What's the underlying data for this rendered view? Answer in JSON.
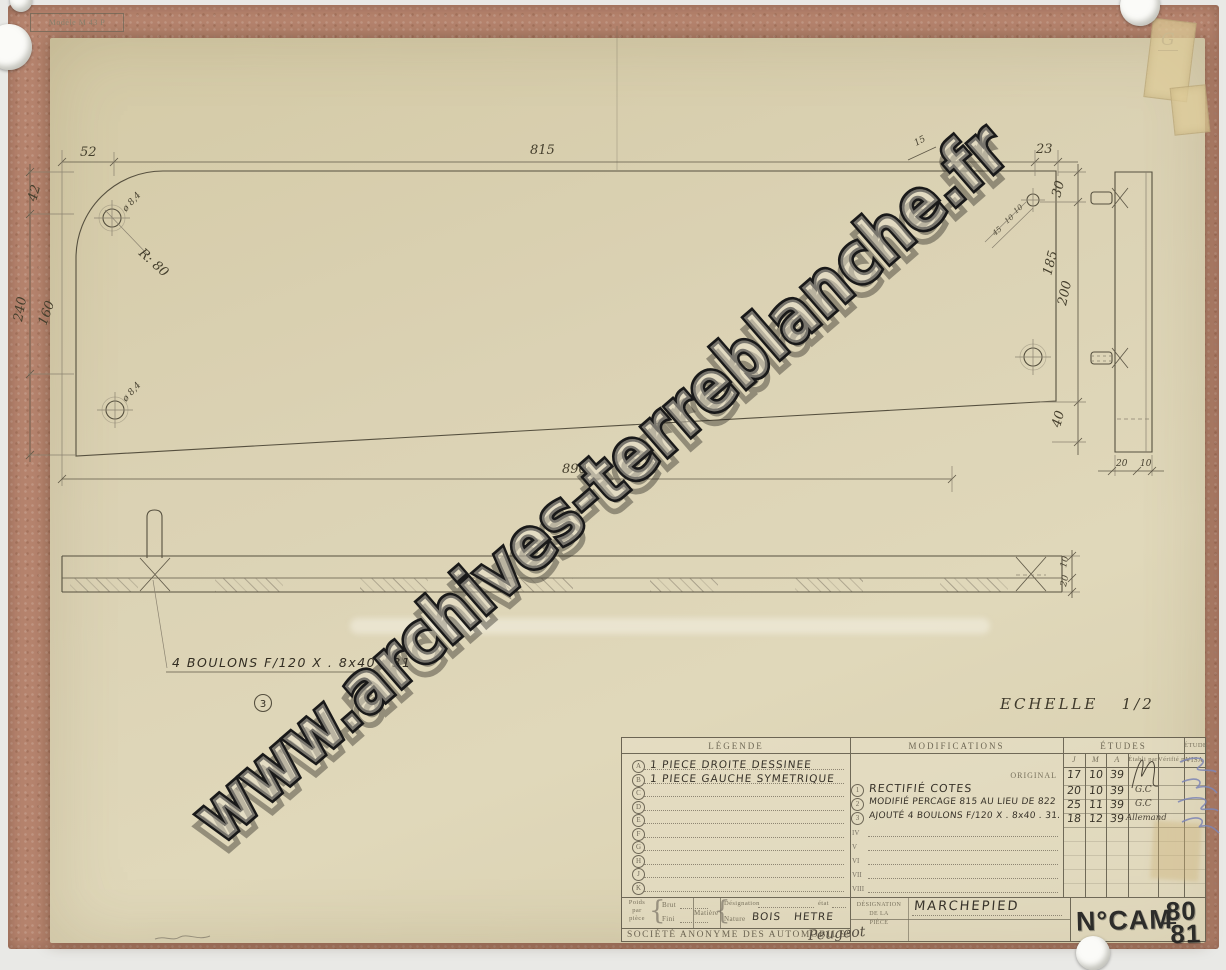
{
  "photo": {
    "corner_mark": "G"
  },
  "stamps": {
    "modele": "Modèle M 43 P",
    "num_label": "N°CAM",
    "num_top": "80",
    "num_bottom": "81"
  },
  "watermark": "www.archives-terreblanche.fr",
  "scale": {
    "label": "ECHELLE",
    "value": "1/2"
  },
  "dims": {
    "top_52": "52",
    "top_815": "815",
    "top_15": "15",
    "top_23": "23",
    "left_42": "42",
    "left_240": "240",
    "left_160": "160",
    "right_30": "30",
    "right_185": "185",
    "right_200": "200",
    "right_40": "40",
    "bottom_890": "890",
    "side_20": "20",
    "side_10": "10",
    "strip_10": "10",
    "strip_20": "20",
    "radius": "R: 80",
    "hole_tl": "ø 8,4",
    "hole_bl": "ø 8,4",
    "tr_45": "45",
    "tr_10a": "10",
    "tr_10b": "10"
  },
  "notes": {
    "bolts": "4 BOULONS F/120 X . 8x40 . 31",
    "callout": "3"
  },
  "titleblock": {
    "legende": {
      "header": "LÉGENDE",
      "rows": [
        {
          "key": "A",
          "text": "1 PIECE DROITE DESSINEE"
        },
        {
          "key": "B",
          "text": "1 PIECE GAUCHE SYMETRIQUE"
        },
        {
          "key": "C",
          "text": ""
        },
        {
          "key": "D",
          "text": ""
        },
        {
          "key": "E",
          "text": ""
        },
        {
          "key": "F",
          "text": ""
        },
        {
          "key": "G",
          "text": ""
        },
        {
          "key": "H",
          "text": ""
        },
        {
          "key": "J",
          "text": ""
        },
        {
          "key": "K",
          "text": ""
        }
      ]
    },
    "modifications": {
      "header": "MODIFICATIONS",
      "original_label": "ORIGINAL",
      "rows": [
        {
          "num": "1",
          "text": "RECTIFIÉ COTES"
        },
        {
          "num": "2",
          "text": "MODIFIÉ PERCAGE 815 AU LIEU DE 822"
        },
        {
          "num": "3",
          "text": "AJOUTÉ 4 BOULONS F/120 X . 8x40 . 31."
        }
      ],
      "empty_rows": [
        "IV",
        "V",
        "VI",
        "VII",
        "VIII"
      ]
    },
    "etudes": {
      "header": "ÉTUDES",
      "col_j": "J",
      "col_m": "M",
      "col_a": "A",
      "col_etabli": "Établi par",
      "col_verifie": "Vérifié par",
      "rows": [
        {
          "j": "17",
          "m": "10",
          "a": "39",
          "par": ""
        },
        {
          "j": "20",
          "m": "10",
          "a": "39",
          "par": "G.C"
        },
        {
          "j": "25",
          "m": "11",
          "a": "39",
          "par": "G.C"
        },
        {
          "j": "18",
          "m": "12",
          "a": "39",
          "par": "Allemand"
        }
      ]
    },
    "visa": {
      "header": "ÉTUDE",
      "sub": "VISA"
    },
    "poids": {
      "l1": "Poids",
      "l2": "par",
      "l3": "pièce",
      "brut": "Brut",
      "fini": "Fini"
    },
    "matiere": {
      "label": "Matière",
      "designation": "Désignation",
      "etat": "état",
      "nature": "Nature",
      "value_a": "BOIS",
      "value_b": "HETRE"
    },
    "societe": {
      "name": "SOCIÉTÉ ANONYME DES AUTOMOBILES",
      "brand": "Peugeot"
    },
    "designation": {
      "l1": "DÉSIGNATION",
      "l2": "DE LA",
      "l3": "PIÈCE",
      "value": "MARCHEPIED"
    }
  }
}
